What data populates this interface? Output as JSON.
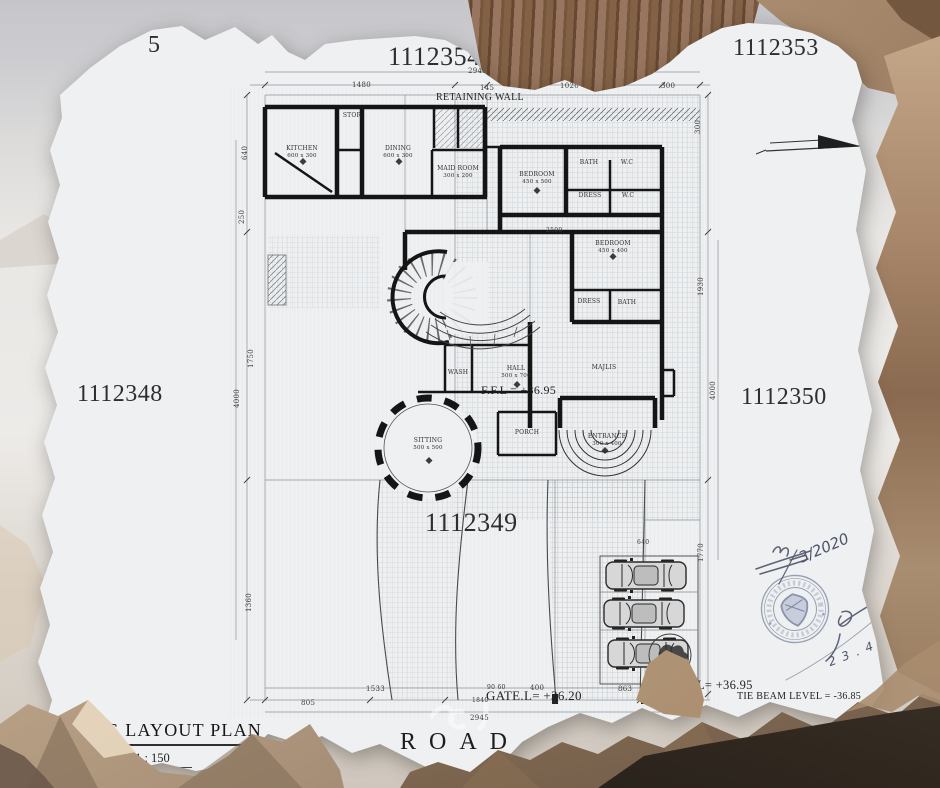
{
  "plot_numbers": {
    "far_left_partial": "5",
    "top_center": "1112354",
    "top_right": "1112353",
    "west": "1112348",
    "east": "1112350",
    "south": "1112349"
  },
  "site_labels": {
    "retaining_wall": "RETAINING WALL",
    "road": "ROAD",
    "ffl": "F.F.L = +36.95",
    "ffl_right": "L= +36.95",
    "gate_level": "GATE.L= +36.20",
    "tie_beam_level": "TIE BEAM LEVEL = -36.85"
  },
  "title_block": {
    "plan_title": "ING  LAYOUT PLAN",
    "scale": "Scale1 : 150"
  },
  "handwriting": {
    "permit_no": "3/2020",
    "date": "2 3 . 4 . 20 20"
  },
  "rooms": {
    "kitchen": {
      "name": "KITCHEN",
      "size": "600 x 300"
    },
    "stor": {
      "name": "STOR"
    },
    "dining": {
      "name": "DINING",
      "size": "600 x 300"
    },
    "maid": {
      "name": "MAID ROOM",
      "size": "300 x 200"
    },
    "bedroom1": {
      "name": "BEDROOM",
      "size": "450 x 500"
    },
    "bath1": {
      "name": "BATH"
    },
    "wc1": {
      "name": "W.C"
    },
    "dress1": {
      "name": "DRESS"
    },
    "wc2": {
      "name": "W.C"
    },
    "bedroom2": {
      "name": "BEDROOM",
      "size": "450 x 400"
    },
    "dress2": {
      "name": "DRESS"
    },
    "bath2": {
      "name": "BATH"
    },
    "hall": {
      "name": "HALL",
      "size": "500 x 700"
    },
    "majlis": {
      "name": "MAJLIS"
    },
    "wash": {
      "name": "WASH"
    },
    "sitting": {
      "name": "SITTING",
      "size": "500 x 500"
    },
    "porch": {
      "name": "PORCH"
    },
    "entrance": {
      "name": "ENTRANCE",
      "size": "300 x 400"
    }
  },
  "dims": {
    "t2945": "2945",
    "t1480": "1480",
    "t145": "145",
    "t1020": "1020",
    "t300": "300",
    "t300v": "300",
    "l640": "640",
    "l250": "250",
    "l1750": "1750",
    "l4000": "4000",
    "l1360": "1360",
    "r1930": "1930",
    "r4000": "4000",
    "r1770": "1770",
    "b805": "805",
    "b1533": "1533",
    "b9060": "90 60",
    "b400": "400",
    "b1840": "1840",
    "b863": "863",
    "b2945": "2945",
    "i2500": "2500",
    "i640": "640"
  },
  "icons": {
    "north_arrow": "north-arrow-icon",
    "seal": "municipal-seal-shield-icon",
    "tree": "tree-icon",
    "cars": "parked-car-top-view-icon"
  },
  "colors": {
    "paper": "#eef0f1",
    "ink": "#151515",
    "dim_text": "#3a3a3a",
    "stamp_blue": "#7e88a2",
    "pencil": "#4d5468",
    "rock_tan": "#c4ab90",
    "rock_dark": "#46392d",
    "sky_gray": "#c6c6ca",
    "wood_brown": "#826144"
  }
}
